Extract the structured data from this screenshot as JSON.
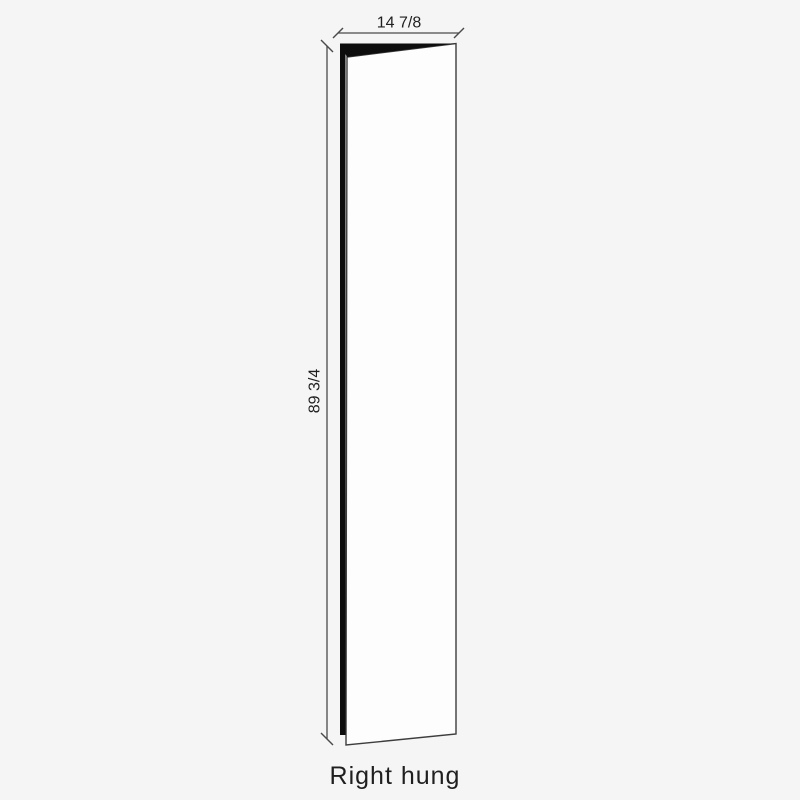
{
  "figure": {
    "caption": "Right hung",
    "width_dimension": "14 7/8",
    "height_dimension": "89 3/4"
  },
  "colors": {
    "background": "#f5f5f5",
    "door_face": "#fdfdfd",
    "door_edge_fill": "#0d0d0d",
    "outline": "#3d3d3d",
    "dimension_line": "#4a4a4a",
    "text": "#1f1f1f"
  }
}
